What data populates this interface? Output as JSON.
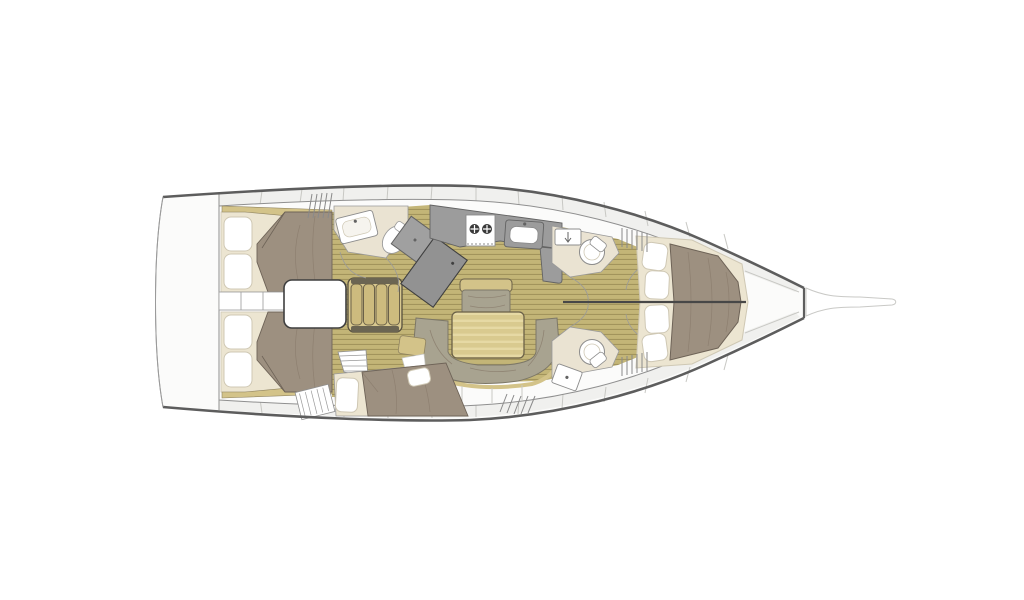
{
  "meta": {
    "title": "sailboat-interior-deck-plan",
    "view": "top-down",
    "orientation": "bow-right"
  },
  "palette": {
    "background": "#ffffff",
    "deck": "#fbfbfa",
    "sideDeck": "#f0f0ee",
    "gunwale": "#5d5d5d",
    "hullLine": "#9a9a9a",
    "innerLine": "#d6d6d2",
    "wall": "#8f8f8f",
    "bowsprit": "#c9c9c6",
    "floorBase": "#c3b577",
    "floorLine": "#a2945c",
    "mattress": "#ece5d1",
    "pillow": "#ffffff",
    "pillowEdge": "#cfc8b4",
    "duvet": "#9d9080",
    "duvetEdge": "#6e6357",
    "crease": "#87796a",
    "sofa": "#a8a390",
    "sofaEdge": "#7c7767",
    "woodTrim": "#d3c389",
    "woodTrimEdge": "#8f8360",
    "tableEdge": "#6b6148",
    "tableBase": "#d9ca8f",
    "tableStripe": "#e6d9a4",
    "counter": "#9c9c9c",
    "counterEdge": "#636363",
    "headFloor": "#eae3d2",
    "fixtureWhite": "#ffffff",
    "fixtureEdge": "#8c8c8c",
    "stairWood": "#d9c98f",
    "stairTread": "#cdbb7e",
    "stairEdge": "#57503f",
    "stairCap": "#6b6552",
    "engineBoxEdge": "#3f3f3f",
    "burner": "#3a3a3a",
    "slat": "#8a8a8a",
    "divider": "#c8c8c4"
  },
  "inventory": {
    "aft_cabins": 2,
    "mid_cabin_berths": 1,
    "forward_cabins": 1,
    "heads": 3,
    "toilets": 3,
    "sinks": 4,
    "pillows_forward_cabin": 4,
    "pillows_per_aft_cabin": 2,
    "pillows_mid_cabin": 2,
    "stove_burners": 2,
    "companionway_steps": 4,
    "salon_table": 1,
    "salon_sofa_sections": 1,
    "nav_station_units": 2
  },
  "regions": [
    {
      "id": "swim-platform"
    },
    {
      "id": "aft-cabin-port"
    },
    {
      "id": "aft-cabin-starboard"
    },
    {
      "id": "engine-box"
    },
    {
      "id": "companionway-stairs"
    },
    {
      "id": "aft-head-port"
    },
    {
      "id": "nav-station"
    },
    {
      "id": "galley"
    },
    {
      "id": "salon"
    },
    {
      "id": "mid-cabin-starboard"
    },
    {
      "id": "forward-head-port"
    },
    {
      "id": "forward-head-starboard"
    },
    {
      "id": "forward-cabin"
    },
    {
      "id": "anchor-locker"
    },
    {
      "id": "bowsprit"
    }
  ]
}
